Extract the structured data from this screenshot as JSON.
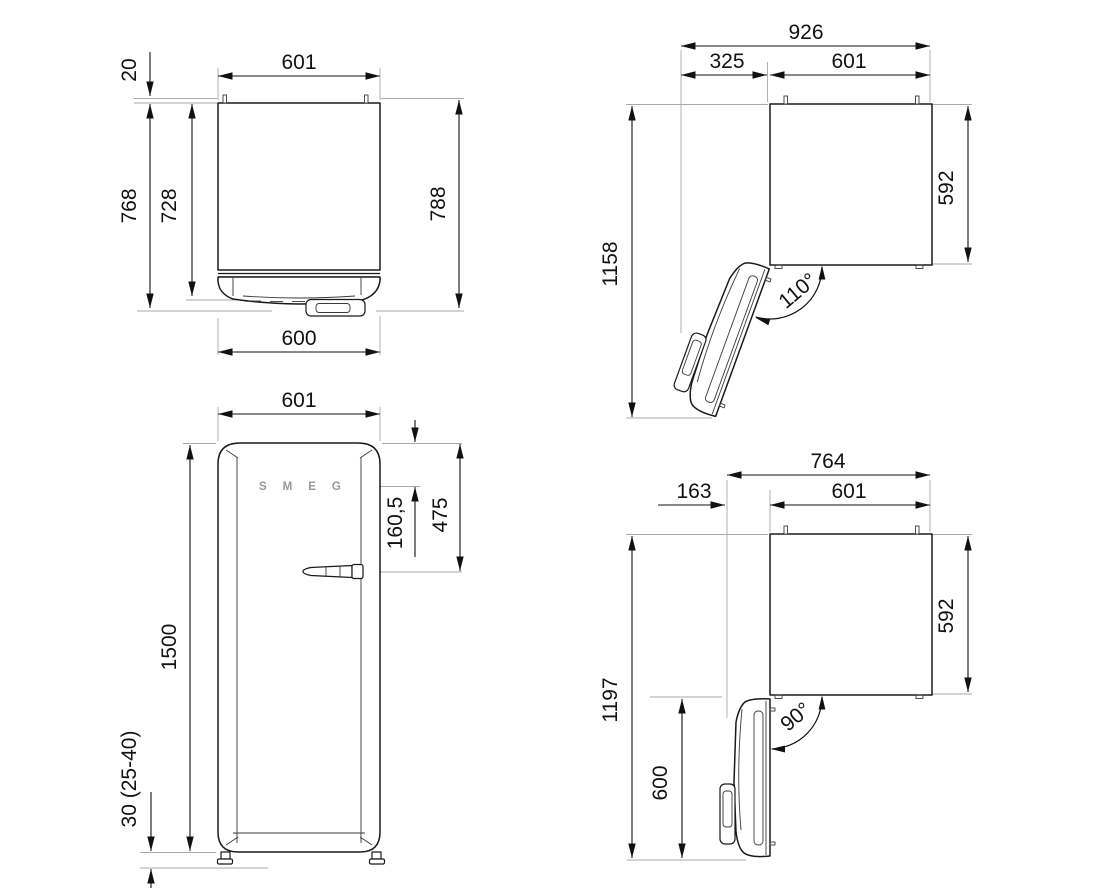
{
  "drawing": {
    "product": "refrigerator-dimension-drawing",
    "brand_logo": "SMEG",
    "views": {
      "top_closed": {
        "width_top": "601",
        "rear_gap": "20",
        "depth_overall": "768",
        "depth_body": "728",
        "depth_total": "788",
        "width_bottom": "600"
      },
      "top_open_110": {
        "width_overall": "926",
        "door_protrusion": "325",
        "width_body": "601",
        "depth_overall": "1158",
        "depth_body": "592",
        "angle": "110°"
      },
      "front": {
        "width": "601",
        "height": "1500",
        "control_offset": "160,5",
        "handle_offset": "475",
        "feet_height": "30 (25-40)"
      },
      "top_open_90": {
        "width_overall": "764",
        "door_protrusion": "163",
        "width_body": "601",
        "depth_overall": "1197",
        "depth_body": "592",
        "door_width": "600",
        "angle": "90°"
      }
    }
  }
}
